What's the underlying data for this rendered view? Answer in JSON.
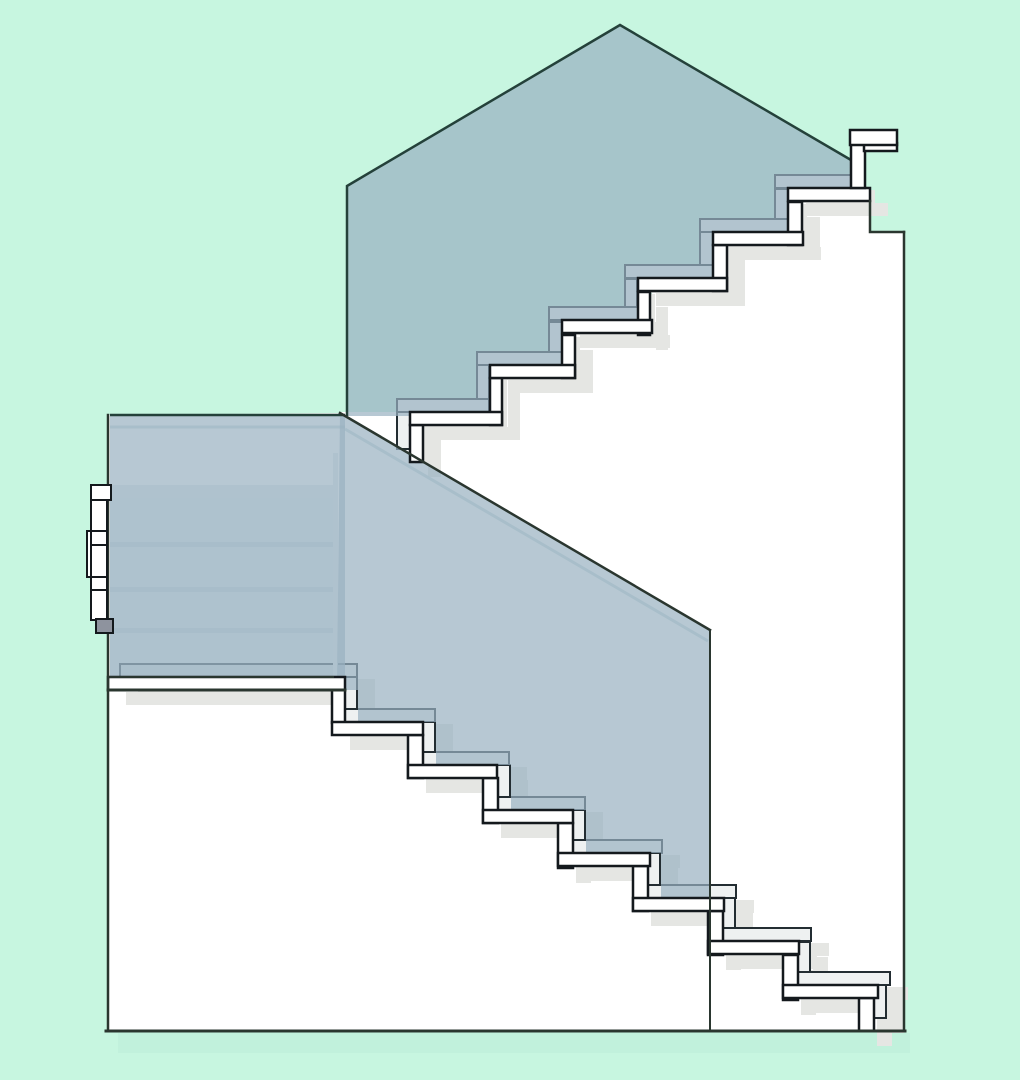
{
  "drawing": {
    "kind": "staircase-section-elevation",
    "upper_flight_steps": 6,
    "lower_flight_steps": 8,
    "has_text": false
  },
  "colors": {
    "background": "#c7f6e0",
    "under_shadow": "#bdeed8",
    "building_fill": "#ffffff",
    "outline_dark": "#2a362f",
    "stair_stroke": "#14191d",
    "stair_fill": "#ffffff",
    "ghost_fill": "#eef1f1",
    "ghost_stroke": "#232d32",
    "shadow": "#e5e6e3",
    "panel_fill": "#98b1c1",
    "panel_opacity": "0.70",
    "panel_overlay_opacity": "0.28",
    "panel_edge": "#24413a",
    "rail_light": "#e4ecee",
    "light_line": "#cddde0",
    "jamb_gray": "#8e939e"
  }
}
